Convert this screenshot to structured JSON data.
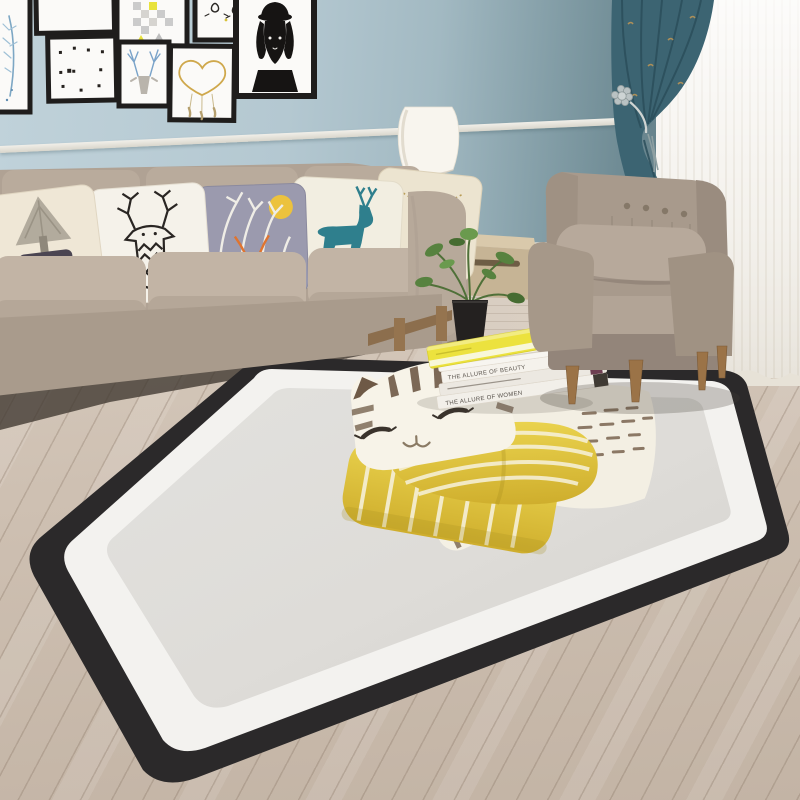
{
  "scene": {
    "setting": "living room",
    "focal_item": "black-bordered area rug with watercolor cat wearing yellow striped scarf"
  },
  "palette": {
    "wall_light": "#c0d2da",
    "wall_dark": "#52707a",
    "chair_rail": "#eceae4",
    "curtain_teal": "#3c6472",
    "curtain_gold_fleck": "#c89a52",
    "sheer_white": "#f2efe9",
    "floor_wood": "#cdbfb1",
    "floor_back_wood": "#d8cdc0",
    "sofa_linen": "#b2a496",
    "armchair_linen": "#a89a8c",
    "wood_legs": "#95744f",
    "rug_border": "#2b292a",
    "rug_inner_band": "#f3f2ef",
    "rug_field": "#dedcd8",
    "cat_cream": "#f6f2e7",
    "cat_brown": "#6e5946",
    "scarf_yellow": "#e3c93f",
    "pillow_lavender": "#9b9aae",
    "pillow_deer_teal": "#2f7f8d",
    "pillow_heart_orange": "#e55f2a",
    "plant_green": "#57823f",
    "planter_black": "#242120",
    "book_yellow": "#ece23e",
    "book_magenta": "#c43c88",
    "lamp_shade": "#f8f5ee"
  },
  "gallery": {
    "frames": [
      {
        "art": "blue feather"
      },
      {
        "art": "blank"
      },
      {
        "art": "gray-yellow checkerboard"
      },
      {
        "art": "kitten doodles"
      },
      {
        "art": "dachshund in hat"
      },
      {
        "art": "scattered dots"
      },
      {
        "art": "deer with blue antlers"
      },
      {
        "art": "gold heart dreamcatcher"
      }
    ]
  },
  "sofa": {
    "pillows": [
      {
        "motif": "gray tree over planter with orange heart"
      },
      {
        "motif": "black and white geometric deer head"
      },
      {
        "motif": "white branches, yellow moon, orange deer head"
      },
      {
        "motif": "teal deer silhouette"
      },
      {
        "motif": "bow tie with dotted swag"
      }
    ]
  },
  "texts": {
    "spine_top": "THE ALLURE OF BEAUTY",
    "spine_bottom": "THE ALLURE OF WOMEN",
    "pillow_quote": "you are in my heart"
  },
  "objects": {
    "sofa": "three-seat beige linen sofa",
    "armchair": "button-tufted taupe armchair with lumbar pillow",
    "rug": "cat print rug: black border, white band, gray field",
    "lamp": "white table lamp",
    "plant": "potted green plant",
    "books": "stacked books with yellow book on top",
    "curtains": "teal patterned curtain with flower holdback over white sheer"
  }
}
